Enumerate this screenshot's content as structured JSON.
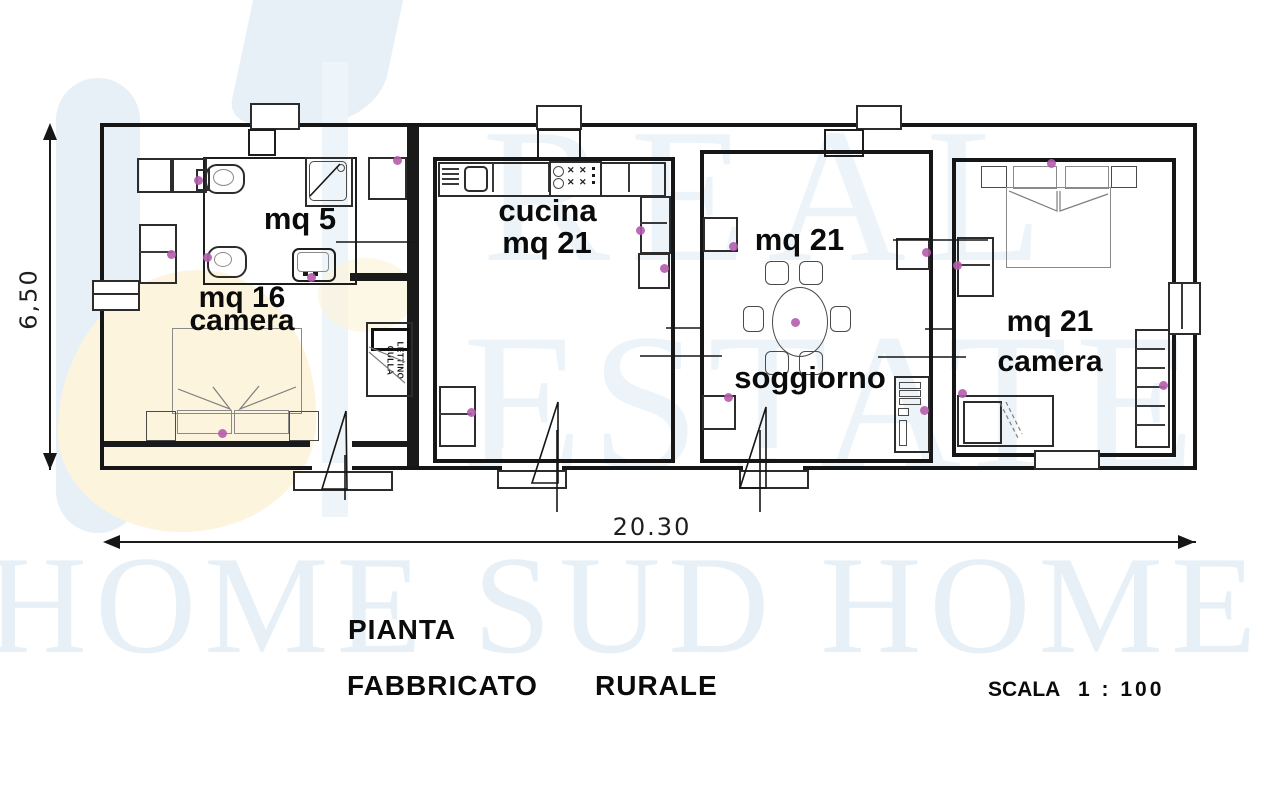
{
  "watermark": {
    "brand_row1": "REAL",
    "brand_row2": "ESTATE",
    "brand_bottom": "HOME SUD HOME",
    "tint_blue": "#e7f0f7",
    "tint_yellow": "#fcf4dc"
  },
  "dimensions": {
    "width_label": "20.30",
    "height_label": "6,50"
  },
  "rooms": {
    "bath": {
      "area": "mq 5"
    },
    "camera_left": {
      "area": "mq 16",
      "name": "camera"
    },
    "cucina": {
      "name": "cucina",
      "area": "mq 21"
    },
    "soggiorno": {
      "area": "mq 21",
      "name": "soggiorno"
    },
    "camera_right": {
      "area": "mq 21",
      "name": "camera"
    }
  },
  "furniture": {
    "crib_line1": "LETTINO",
    "crib_line2": "CULLA"
  },
  "footer": {
    "title": "PIANTA",
    "subtitle_word1": "FABBRICATO",
    "subtitle_word2": "RURALE",
    "scale_label": "SCALA",
    "scale_value": "1 : 100"
  },
  "marker_color": "#b55cad"
}
